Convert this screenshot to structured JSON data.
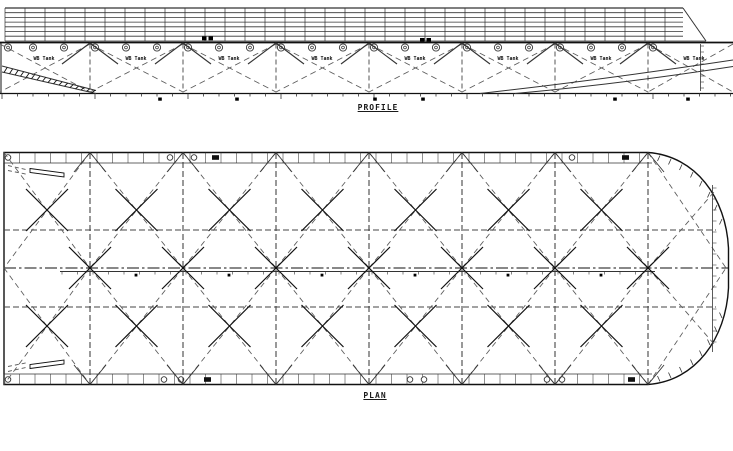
{
  "colors": {
    "background": "#ffffff",
    "line_dark": "#111111",
    "line_mid": "#333333",
    "line_soft": "#444444",
    "line_dash": "#5a5a5a",
    "fill_black": "#000000"
  },
  "profile": {
    "caption": "PROFILE",
    "tank_label": "WB Tank",
    "tank_label_x": [
      44,
      136,
      229,
      322,
      415,
      508,
      601,
      694
    ],
    "tank_label_y": 60,
    "grid": {
      "x0": 5,
      "x1": 683,
      "y0": 8,
      "rows": [
        8,
        12.7,
        17.4,
        22.1,
        26.8,
        31.5,
        36.2,
        41
      ],
      "col_step": 20,
      "taper_x": 706
    },
    "deck_y": 42.5,
    "vent_circles_y": 47.5,
    "vent_circles_x": [
      8,
      33,
      64,
      95,
      126,
      157,
      188,
      219,
      250,
      281,
      312,
      343,
      374,
      405,
      436,
      467,
      498,
      529,
      560,
      591,
      622,
      653
    ],
    "bulkheads_x": [
      90,
      183,
      276,
      369,
      462,
      555,
      648
    ],
    "bays": [
      [
        0,
        90
      ],
      [
        90,
        183
      ],
      [
        183,
        276
      ],
      [
        276,
        369
      ],
      [
        369,
        462
      ],
      [
        462,
        555
      ],
      [
        555,
        648
      ],
      [
        648,
        733
      ]
    ],
    "baseline_y": 93.5,
    "tick_step": 15.5,
    "black_marks_x": [
      160,
      237,
      375,
      423,
      615,
      688
    ],
    "deck_fitting_squares": [
      [
        202,
        36.5
      ],
      [
        208.5,
        36.5
      ],
      [
        420,
        38
      ],
      [
        426.5,
        38
      ]
    ],
    "bow_vertical_x": 700.5,
    "skeg": {
      "x0": 2,
      "x1": 96,
      "ytop0": 66,
      "ytop1": 90.5,
      "ybot0": 72,
      "ybot1": 93.5,
      "hatch_count": 17
    }
  },
  "plan": {
    "caption": "PLAN",
    "hull": {
      "x0": 4,
      "y_top": 152.5,
      "y_bot": 384.5,
      "body_x1": 648,
      "tip_x": 728.5,
      "tip_y0": 248,
      "tip_y1": 288
    },
    "band_inner_top_y": 163,
    "band_inner_bot_y": 374,
    "band_tick_step": 15.5,
    "top_band_circles_x": [
      8,
      170,
      194,
      572
    ],
    "top_band_rects_x": [
      212,
      622
    ],
    "bottom_band_circles_x": [
      8,
      164,
      181,
      410,
      424,
      547,
      562
    ],
    "bottom_band_rects_x": [
      204,
      628
    ],
    "bulkheads_x": [
      90,
      183,
      276,
      369,
      462,
      555,
      648
    ],
    "centerline_y": 268,
    "girder_lines_y": [
      230,
      307
    ],
    "scale_line": {
      "y": 271.5,
      "x0": 60,
      "x1": 655,
      "marks_x": [
        136,
        229,
        322,
        415,
        508,
        601
      ]
    },
    "bays": [
      [
        4,
        90
      ],
      [
        90,
        183
      ],
      [
        183,
        276
      ],
      [
        276,
        369
      ],
      [
        369,
        462
      ],
      [
        462,
        555
      ],
      [
        555,
        648
      ]
    ],
    "bow_tip": [
      726,
      268
    ],
    "midbays_x": [
      47,
      136.5,
      229.5,
      322.5,
      415.5,
      508.5,
      601.5
    ],
    "cross_rows_y": [
      210,
      326
    ],
    "bow_curve_ticks_top": [
      [
        660,
        155.5
      ],
      [
        671,
        159
      ],
      [
        682,
        164.5
      ],
      [
        693,
        172
      ],
      [
        702,
        181
      ],
      [
        710,
        192
      ],
      [
        717,
        205
      ],
      [
        722,
        219
      ]
    ],
    "bow_curve_ticks_bottom": [
      [
        660,
        381.5
      ],
      [
        671,
        378
      ],
      [
        682,
        372.5
      ],
      [
        693,
        365
      ],
      [
        702,
        356
      ],
      [
        710,
        345
      ],
      [
        717,
        332
      ],
      [
        722,
        318
      ]
    ],
    "bow_frame_line": {
      "x": 712.5,
      "y0": 185,
      "y1": 352
    }
  }
}
